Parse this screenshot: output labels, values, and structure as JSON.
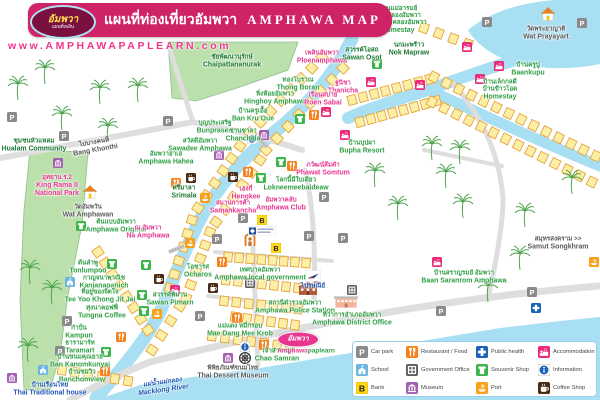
{
  "header": {
    "logo_thai": "อัมพวา",
    "logo_sub": "แผนที่เพลิน",
    "title_thai": "แผนที่ท่องเที่ยวอัมพวา",
    "title_en": "AMPHAWA MAP",
    "website": "www.AMPHAWAPAPLEARN.com"
  },
  "colors": {
    "banner_pink": "#cf2368",
    "accent_pink": "#e8368f",
    "label_green": "#2f9e44",
    "water": "#a9dff2",
    "building_fill": "#fbefa6",
    "building_border": "#e8a238",
    "park_green": "#bce0ac",
    "road_gray": "#dedede",
    "icon_restaurant": "#f5821f",
    "icon_health": "#1c63b7",
    "icon_accommodation": "#ee2a7b",
    "icon_school": "#6cb5e3",
    "icon_government": "#5f5f5f",
    "icon_souvenir": "#3bb54a",
    "icon_bank": "#ffd816",
    "icon_museum": "#a45fb0",
    "icon_port": "#f9a11b",
    "icon_coffee": "#4a2b16",
    "icon_parking": "#8a8a8a"
  },
  "legend": {
    "items": [
      {
        "type": "pk",
        "label": "Car park"
      },
      {
        "type": "rs",
        "label": "Restaurant / Food"
      },
      {
        "type": "ph",
        "label": "Public health"
      },
      {
        "type": "ac",
        "label": "Accommodation"
      },
      {
        "type": "sc",
        "label": "School"
      },
      {
        "type": "gv",
        "label": "Government Office"
      },
      {
        "type": "sv",
        "label": "Souvenir Shop"
      },
      {
        "type": "in",
        "label": "Information"
      },
      {
        "type": "bk",
        "label": "Bank"
      },
      {
        "type": "mu",
        "label": "Museum"
      },
      {
        "type": "pt",
        "label": "Port"
      },
      {
        "type": "cf",
        "label": "Coffee Shop"
      }
    ]
  },
  "badge": {
    "thai": "อัมพวา",
    "text_pink": "Amphawa",
    "text_green": "paplearn"
  },
  "map": {
    "places": [
      {
        "t": "บ้านแม่อารมย์|บ้านคลองอัมพวา|บ้านโฮมคลองอัมพวา",
        "e": "Homestay",
        "x": 398,
        "y": 20,
        "c": "g"
      },
      {
        "t": "วัดพระยาญาติ",
        "e": "Wat Prayayart",
        "x": 546,
        "y": 34,
        "c": "d"
      },
      {
        "t": "เพลินอัมพวา",
        "e": "Ploenamphawa",
        "x": 322,
        "y": 58,
        "c": "p"
      },
      {
        "t": "สวรรค์โอสถ",
        "e": "Sawan Osot",
        "x": 362,
        "y": 55,
        "c": "dg"
      },
      {
        "t": "นกมะพร้าว",
        "e": "Nok Mapraw",
        "x": 409,
        "y": 50,
        "c": "dg"
      },
      {
        "t": "บ้านครูปู",
        "e": "Baankupu",
        "x": 528,
        "y": 70,
        "c": "g"
      },
      {
        "t": "บ้านเล็กกลดี|บ้านข้าวโอด",
        "e": "Homestay",
        "x": 500,
        "y": 90,
        "c": "g"
      },
      {
        "t": "ชัยพัฒนานุรักษ์",
        "e": "Chaipattananurak",
        "x": 232,
        "y": 62,
        "c": "dg"
      },
      {
        "t": "ทองโบราณ",
        "e": "Thong Boran",
        "x": 298,
        "y": 85,
        "c": "g"
      },
      {
        "t": "ฐนิชา",
        "e": "Thanicha",
        "x": 343,
        "y": 88,
        "c": "p"
      },
      {
        "t": "หิ่งห้อยอัมพวา",
        "e": "Hinghoy Amphawa",
        "x": 275,
        "y": 99,
        "c": "g"
      },
      {
        "t": "เรือนสบาย",
        "e": "Roen Sabai",
        "x": 323,
        "y": 100,
        "c": "p"
      },
      {
        "t": "บ้านครูเอื้อ",
        "e": "Ban Kru Oue",
        "x": 253,
        "y": 116,
        "c": "g"
      },
      {
        "t": "บุญประเสริฐ",
        "e": "Bunprasert",
        "x": 215,
        "y": 128,
        "c": "g"
      },
      {
        "t": "ชานชาลา",
        "e": "Chanchala",
        "x": 243,
        "y": 136,
        "c": "g"
      },
      {
        "t": "สวัสดีอัมพวา",
        "e": "Sawadee Amphawa",
        "x": 200,
        "y": 146,
        "c": "g"
      },
      {
        "t": "อัมพวาฮาเฮ",
        "e": "Amphawa Hahea",
        "x": 166,
        "y": 159,
        "c": "g"
      },
      {
        "t": "ศรีมาลา",
        "e": "Srimala",
        "x": 184,
        "y": 193,
        "c": "dg"
      },
      {
        "t": "เฮงกี่",
        "e": "Hengkee",
        "x": 246,
        "y": 194,
        "c": "p"
      },
      {
        "t": "สมานการค้า",
        "e": "Samankancha",
        "x": 233,
        "y": 208,
        "c": "p"
      },
      {
        "t": "อัมพวาคลับ",
        "e": "Amphawa Club",
        "x": 281,
        "y": 205,
        "c": "p"
      },
      {
        "t": "โลกนี้มีใบเดียว",
        "e": "Lokneemeebaideaw",
        "x": 296,
        "y": 185,
        "c": "g"
      },
      {
        "t": "ภวัฒน์ส้มตำ",
        "e": "Phawat Somtum",
        "x": 323,
        "y": 170,
        "c": "p"
      },
      {
        "t": "บ้านบุปผา",
        "e": "Bupha Resort",
        "x": 362,
        "y": 148,
        "c": "g"
      },
      {
        "t": "ชุมชนหัวแหลม",
        "e": "Hualam Community",
        "x": 34,
        "y": 146,
        "c": "dg"
      },
      {
        "t": "อุทยาน ร.2",
        "e": "King Rama II|National Park",
        "x": 57,
        "y": 186,
        "c": "p"
      },
      {
        "t": "วัดอัมพวัน",
        "e": "Wat Amphawan",
        "x": 88,
        "y": 212,
        "c": "d"
      },
      {
        "t": "ต้นแบบอัมพวา",
        "e": "Amphawa Original",
        "x": 116,
        "y": 227,
        "c": "g"
      },
      {
        "t": "ณ อัมพวา",
        "e": "Na Amphawa",
        "x": 148,
        "y": 233,
        "c": "p"
      },
      {
        "t": "ต้นลำพู",
        "e": "Tonlumpoo",
        "x": 88,
        "y": 268,
        "c": "g"
      },
      {
        "t": "กาญจนาพาณิช",
        "e": "Kanjanapanich",
        "x": 104,
        "y": 283,
        "c": "g"
      },
      {
        "t": "ที่อยู่ของจิตใจ",
        "e": "Tee Yoo Khong Jit Jai",
        "x": 100,
        "y": 297,
        "c": "g"
      },
      {
        "t": "ทุ่งนาคอฟฟี่",
        "e": "Tungna Coffee",
        "x": 102,
        "y": 313,
        "c": "g"
      },
      {
        "t": "กำปั่น",
        "e": "Kampun",
        "x": 79,
        "y": 333,
        "c": "g"
      },
      {
        "t": "ธารามาร์ท",
        "e": "Taramart",
        "x": 80,
        "y": 348,
        "c": "g"
      },
      {
        "t": "บ้านขนมคุณยาย",
        "e": "Ban Kanomkunyai",
        "x": 80,
        "y": 362,
        "c": "g"
      },
      {
        "t": "บ้านชมวิว",
        "e": "Banchomview",
        "x": 82,
        "y": 377,
        "c": "g"
      },
      {
        "t": "บ้านเรือนไทย",
        "e": "Thai Traditional house",
        "x": 50,
        "y": 390,
        "c": "b"
      },
      {
        "t": "แม่น้ำแม่กลอง",
        "e": "Macklong River",
        "x": 163,
        "y": 387,
        "c": "b",
        "r": -8,
        "i": 1
      },
      {
        "t": "โอชารส",
        "e": "Ocharos",
        "x": 198,
        "y": 272,
        "c": "g"
      },
      {
        "t": "เทศบาลอัมพวา",
        "e": "Amphawa local government",
        "x": 260,
        "y": 275,
        "c": "g"
      },
      {
        "t": "สวรรค์พิมาน",
        "e": "Sawan Pimarn",
        "x": 170,
        "y": 300,
        "c": "g"
      },
      {
        "t": "แม่แดง หมี่กรอบ",
        "e": "Mae Dang Mee Krob",
        "x": 240,
        "y": 331,
        "c": "g"
      },
      {
        "t": "ไปรษณีย์",
        "e": "",
        "x": 313,
        "y": 287,
        "c": "b"
      },
      {
        "t": "สถานีตำรวจอัมพวา",
        "e": "Amphawa Police Station",
        "x": 295,
        "y": 308,
        "c": "g"
      },
      {
        "t": "ที่ว่าการอำเภออัมพวา",
        "e": "Amphawa District Office",
        "x": 352,
        "y": 320,
        "c": "g"
      },
      {
        "t": "บ้านสราญรมย์ อัมพวา",
        "e": "Baan Saranrom Amphawa",
        "x": 464,
        "y": 278,
        "c": "g"
      },
      {
        "t": "สมุทรสงคราม >>",
        "e": "Samut Songkhram",
        "x": 558,
        "y": 244,
        "c": "d"
      },
      {
        "t": "ไปบางคนที",
        "e": "Bang Khonthi",
        "x": 95,
        "y": 147,
        "c": "d",
        "r": -10
      },
      {
        "t": "เจ้าสำราญ",
        "e": "Chao Samran",
        "x": 277,
        "y": 356,
        "c": "g"
      },
      {
        "t": "พิพิธภัณฑ์ขนมไทย",
        "e": "Thai Dessert Museum",
        "x": 233,
        "y": 373,
        "c": "d"
      }
    ],
    "markers": [
      [
        "pk",
        12,
        117
      ],
      [
        "pk",
        64,
        136
      ],
      [
        "pk",
        168,
        121
      ],
      [
        "pk",
        487,
        22
      ],
      [
        "pk",
        582,
        23
      ],
      [
        "pk",
        243,
        218
      ],
      [
        "pk",
        217,
        239
      ],
      [
        "pk",
        324,
        197
      ],
      [
        "pk",
        309,
        236
      ],
      [
        "pk",
        343,
        238
      ],
      [
        "pk",
        532,
        292
      ],
      [
        "pk",
        441,
        311
      ],
      [
        "pk",
        67,
        321
      ],
      [
        "pk",
        60,
        351
      ],
      [
        "pk",
        200,
        316
      ],
      [
        "rs",
        314,
        115
      ],
      [
        "rs",
        176,
        183
      ],
      [
        "rs",
        248,
        172
      ],
      [
        "rs",
        292,
        166
      ],
      [
        "rs",
        222,
        262
      ],
      [
        "rs",
        237,
        318
      ],
      [
        "rs",
        264,
        345
      ],
      [
        "rs",
        121,
        337
      ],
      [
        "rs",
        105,
        371
      ],
      [
        "ac",
        326,
        112
      ],
      [
        "ac",
        345,
        135
      ],
      [
        "ac",
        420,
        85
      ],
      [
        "ac",
        467,
        47
      ],
      [
        "ac",
        499,
        66
      ],
      [
        "ac",
        480,
        79
      ],
      [
        "ac",
        371,
        82
      ],
      [
        "ac",
        175,
        290
      ],
      [
        "ac",
        437,
        262
      ],
      [
        "sv",
        377,
        64
      ],
      [
        "sv",
        300,
        119
      ],
      [
        "sv",
        281,
        162
      ],
      [
        "sv",
        261,
        178
      ],
      [
        "sv",
        112,
        264
      ],
      [
        "sv",
        142,
        295
      ],
      [
        "sv",
        144,
        311
      ],
      [
        "sv",
        106,
        352
      ],
      [
        "sv",
        81,
        226
      ],
      [
        "sv",
        146,
        265
      ],
      [
        "bk",
        262,
        220
      ],
      [
        "bk",
        276,
        248
      ],
      [
        "mu",
        58,
        163
      ],
      [
        "mu",
        12,
        378
      ],
      [
        "mu",
        228,
        358
      ],
      [
        "mu",
        264,
        135
      ],
      [
        "mu",
        219,
        155
      ],
      [
        "gv",
        250,
        283
      ],
      [
        "gv",
        352,
        290
      ],
      [
        "sc",
        70,
        282
      ],
      [
        "sc",
        43,
        370
      ],
      [
        "ph",
        536,
        308
      ],
      [
        "pt",
        190,
        243
      ],
      [
        "pt",
        157,
        314
      ],
      [
        "pt",
        594,
        262
      ],
      [
        "pt",
        205,
        198
      ],
      [
        "in",
        252,
        139
      ],
      [
        "in",
        245,
        347
      ],
      [
        "cf",
        191,
        178
      ],
      [
        "cf",
        233,
        177
      ],
      [
        "cf",
        159,
        279
      ],
      [
        "cf",
        213,
        288
      ],
      [
        "temple",
        90,
        192
      ],
      [
        "temple",
        548,
        14
      ],
      [
        "police",
        308,
        288
      ],
      [
        "office",
        346,
        301
      ],
      [
        "post",
        313,
        276
      ],
      [
        "shrine",
        250,
        239
      ],
      [
        "wheel",
        245,
        358
      ],
      [
        "bbank",
        262,
        231
      ]
    ]
  }
}
